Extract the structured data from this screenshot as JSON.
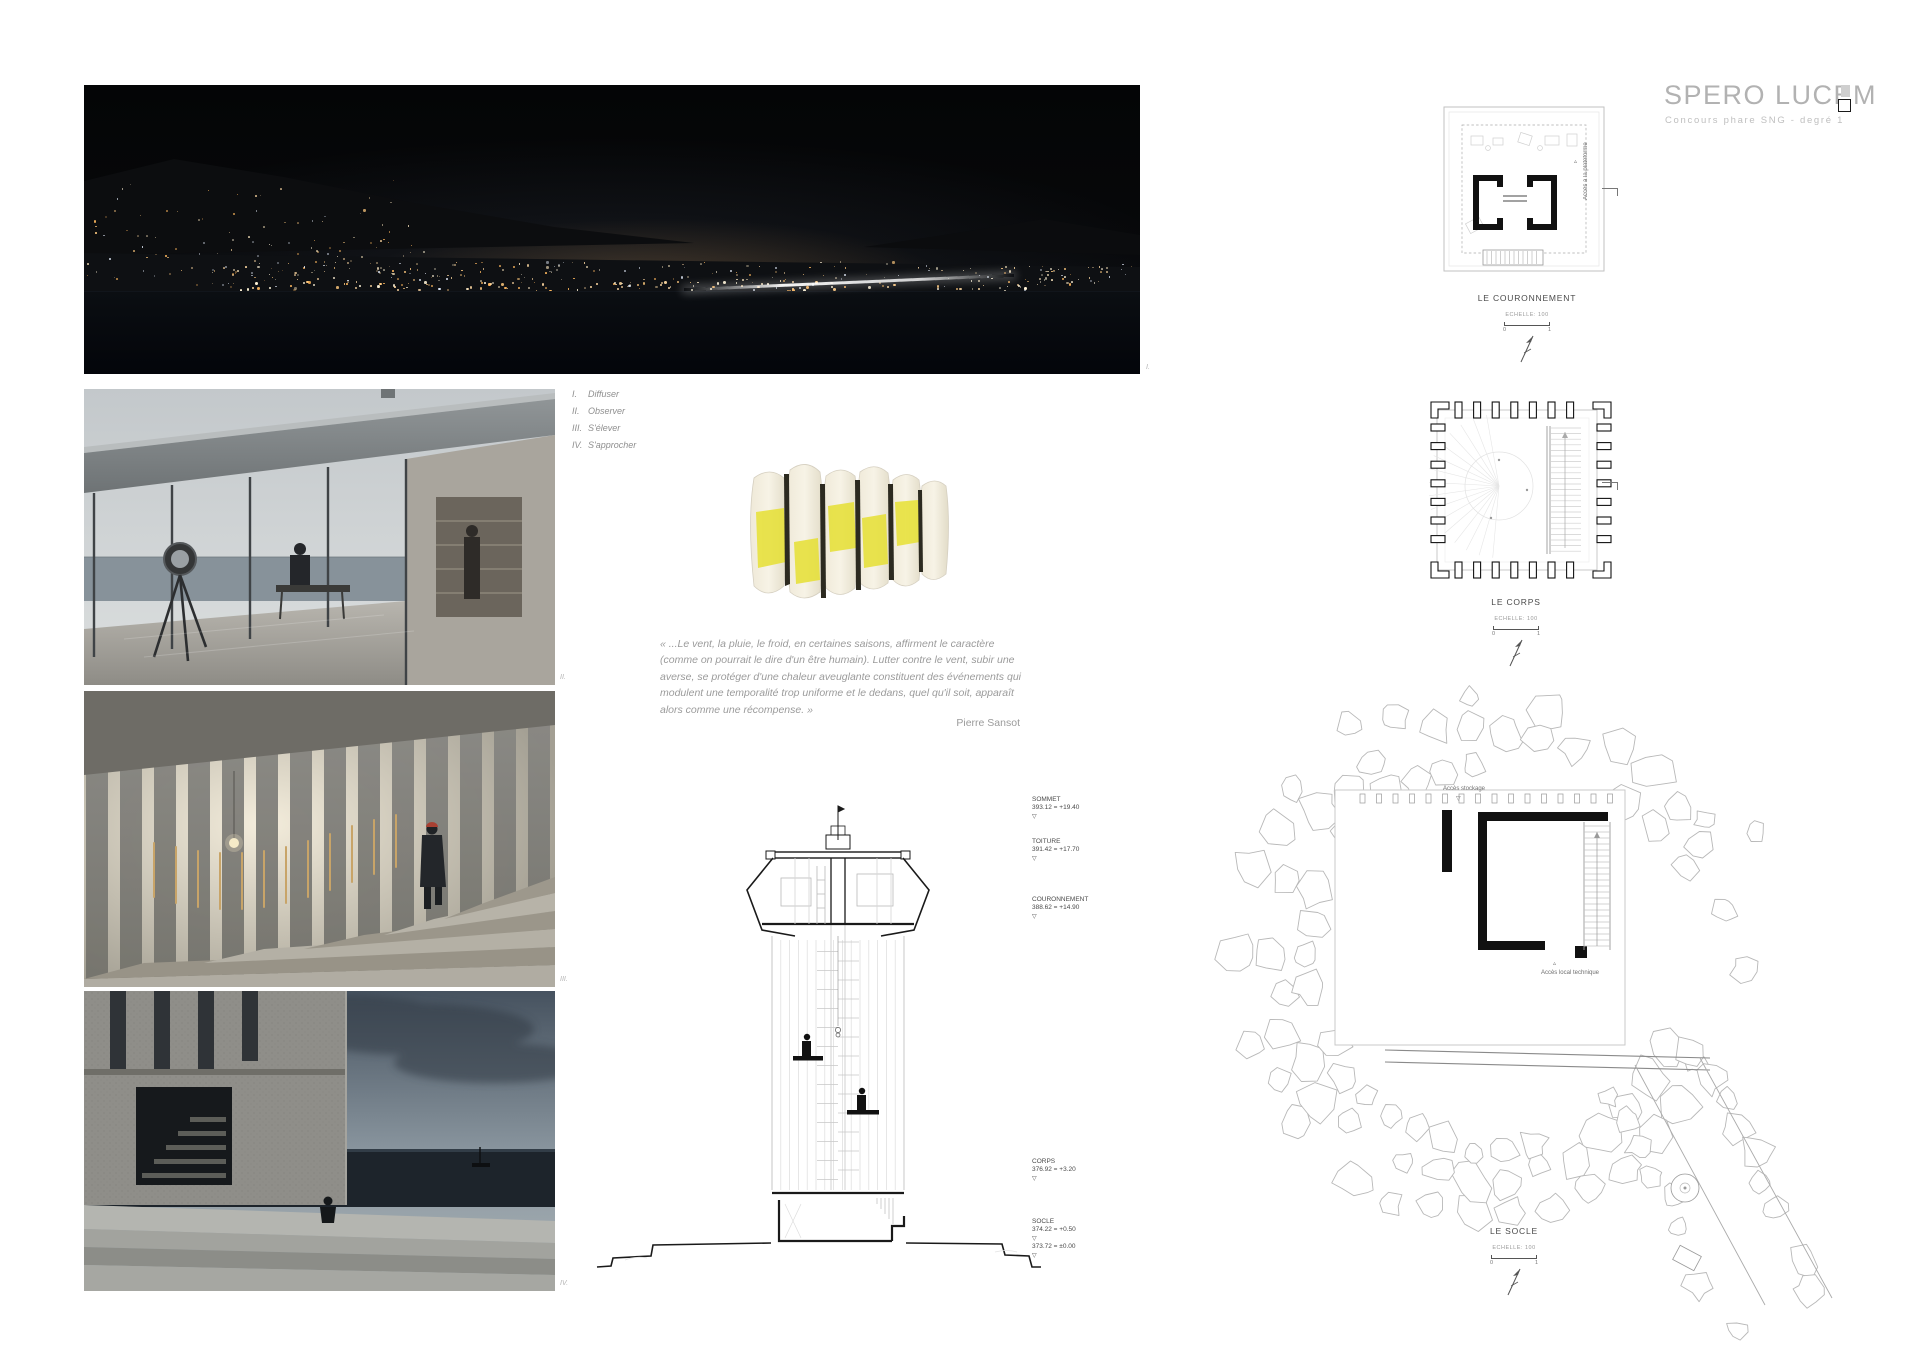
{
  "page": {
    "title": "SPERO LUCEM",
    "subtitle": "Concours phare SNG - degré 1"
  },
  "concepts": [
    {
      "numeral": "I.",
      "label": "Diffuser"
    },
    {
      "numeral": "II.",
      "label": "Observer"
    },
    {
      "numeral": "III.",
      "label": "S'élever"
    },
    {
      "numeral": "IV.",
      "label": "S'approcher"
    }
  ],
  "quote": {
    "text": "« ...Le vent, la pluie, le froid, en certaines saisons, affirment le caractère (comme on pourrait le dire d'un être humain). Lutter contre le vent, subir une averse, se protéger d'une chaleur aveuglante constituent des événements qui modulent une temporalité trop uniforme et le dedans, quel qu'il soit, apparaît alors comme une récompense. »",
    "author": "Pierre Sansot"
  },
  "section": {
    "levels": [
      {
        "name": "SOMMET",
        "value": "393.12 = +19.40"
      },
      {
        "name": "TOITURE",
        "value": "391.42 = +17.70"
      },
      {
        "name": "COURONNEMENT",
        "value": "388.62 = +14.90"
      },
      {
        "name": "CORPS",
        "value": "376.92 = +3.20"
      },
      {
        "name": "SOCLE",
        "value": "374.22 = +0.50",
        "value2": "373.72 = ±0.00"
      }
    ]
  },
  "plans": {
    "couronnement": {
      "title": "LE COURONNEMENT",
      "scale": "ECHELLE: 100",
      "tick0": "0",
      "tick1": "1",
      "annotation": "Accès à la plateforme"
    },
    "corps": {
      "title": "LE CORPS",
      "scale": "ECHELLE: 100",
      "tick0": "0",
      "tick1": "1"
    },
    "socle": {
      "title": "LE SOCLE",
      "scale": "ECHELLE: 100",
      "tick0": "0",
      "tick1": "1",
      "annotation_top": "Accès stockage",
      "annotation_bottom": "Accès local technique"
    }
  },
  "colors": {
    "ink": "#1a1a1a",
    "ghost_line": "#c9c9c9",
    "title_gray": "#b2b2b2",
    "model_yellow": "#e6e033",
    "beanie_red": "#a84133"
  }
}
